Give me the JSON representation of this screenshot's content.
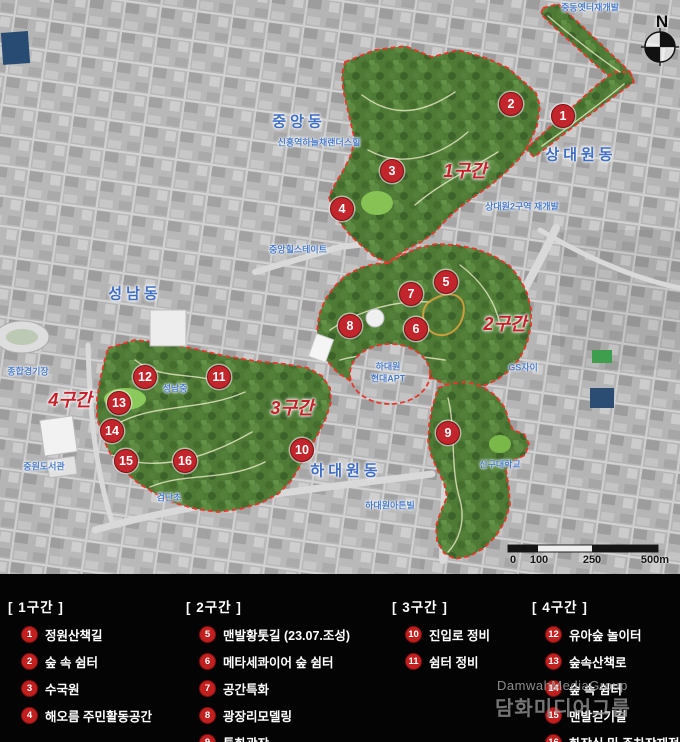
{
  "map": {
    "compass_label": "N",
    "scale_bar": {
      "labels": [
        "0",
        "100",
        "250",
        "500m"
      ]
    },
    "zone_labels": [
      {
        "text": "1구간",
        "x": 465,
        "y": 170
      },
      {
        "text": "2구간",
        "x": 505,
        "y": 323
      },
      {
        "text": "3구간",
        "x": 292,
        "y": 407
      },
      {
        "text": "4구간",
        "x": 70,
        "y": 399
      }
    ],
    "district_labels": [
      {
        "text": "중앙동",
        "x": 299,
        "y": 121
      },
      {
        "text": "상대원동",
        "x": 581,
        "y": 154
      },
      {
        "text": "성남동",
        "x": 135,
        "y": 293
      },
      {
        "text": "하대원동",
        "x": 346,
        "y": 470
      }
    ],
    "place_labels": [
      {
        "text": "중동옛터재개발",
        "x": 590,
        "y": 7
      },
      {
        "text": "신흥역하늘채랜더스힐",
        "x": 319,
        "y": 142
      },
      {
        "text": "상대원2구역 재개발",
        "x": 522,
        "y": 206
      },
      {
        "text": "중앙힐스테이트",
        "x": 298,
        "y": 249
      },
      {
        "text": "성남중",
        "x": 175,
        "y": 388
      },
      {
        "text": "종합경기장",
        "x": 28,
        "y": 371
      },
      {
        "text": "하대원",
        "x": 388,
        "y": 366
      },
      {
        "text": "현대APT",
        "x": 388,
        "y": 378
      },
      {
        "text": "GS자이",
        "x": 523,
        "y": 367
      },
      {
        "text": "신구대학교",
        "x": 500,
        "y": 464
      },
      {
        "text": "중원도서관",
        "x": 44,
        "y": 466
      },
      {
        "text": "검단초",
        "x": 169,
        "y": 497
      },
      {
        "text": "하대원아튼빌",
        "x": 390,
        "y": 505
      }
    ],
    "markers": [
      {
        "n": 1,
        "x": 563,
        "y": 116
      },
      {
        "n": 2,
        "x": 511,
        "y": 104
      },
      {
        "n": 3,
        "x": 392,
        "y": 171
      },
      {
        "n": 4,
        "x": 342,
        "y": 209
      },
      {
        "n": 5,
        "x": 446,
        "y": 282
      },
      {
        "n": 6,
        "x": 416,
        "y": 329
      },
      {
        "n": 7,
        "x": 411,
        "y": 294
      },
      {
        "n": 8,
        "x": 350,
        "y": 326
      },
      {
        "n": 9,
        "x": 448,
        "y": 433
      },
      {
        "n": 10,
        "x": 302,
        "y": 450
      },
      {
        "n": 11,
        "x": 219,
        "y": 377
      },
      {
        "n": 12,
        "x": 145,
        "y": 377
      },
      {
        "n": 13,
        "x": 119,
        "y": 403
      },
      {
        "n": 14,
        "x": 112,
        "y": 431
      },
      {
        "n": 15,
        "x": 126,
        "y": 461
      },
      {
        "n": 16,
        "x": 185,
        "y": 461
      }
    ]
  },
  "legend": {
    "sections": [
      {
        "title": "[ 1구간 ]",
        "items": [
          {
            "num": 1,
            "label": "정원산책길"
          },
          {
            "num": 2,
            "label": "숲 속 쉼터"
          },
          {
            "num": 3,
            "label": "수국원"
          },
          {
            "num": 4,
            "label": "해오름 주민활동공간"
          }
        ]
      },
      {
        "title": "[ 2구간 ]",
        "items": [
          {
            "num": 5,
            "label": "맨발황톳길 (23.07.조성)"
          },
          {
            "num": 6,
            "label": "메타세콰이어 숲 쉼터"
          },
          {
            "num": 7,
            "label": "공간특화"
          },
          {
            "num": 8,
            "label": "광장리모델링"
          },
          {
            "num": 9,
            "label": "특화광장"
          }
        ]
      },
      {
        "title": "[ 3구간 ]",
        "items": [
          {
            "num": 10,
            "label": "진입로 정비"
          },
          {
            "num": 11,
            "label": "쉼터 정비"
          }
        ]
      },
      {
        "title": "[ 4구간 ]",
        "items": [
          {
            "num": 12,
            "label": "유아숲 놀이터"
          },
          {
            "num": 13,
            "label": "숲속산책로"
          },
          {
            "num": 14,
            "label": "숲 속 쉼터"
          },
          {
            "num": 15,
            "label": "맨발걷기길"
          },
          {
            "num": 16,
            "label": "화장실 및 주차장재정비"
          }
        ]
      }
    ]
  },
  "watermark": {
    "line1": "DamwahMediaGroup",
    "line2": "담화미디어그룹"
  },
  "colors": {
    "marker_red": "#c2262c",
    "boundary_red": "#e8372b",
    "zone_label_red": "#c8202a",
    "district_blue": "#3f6ec5",
    "place_blue": "#4a7cc9",
    "park_green": "#4f7a36",
    "city_gray": "#b5b5b5",
    "legend_bg": "#040404"
  }
}
